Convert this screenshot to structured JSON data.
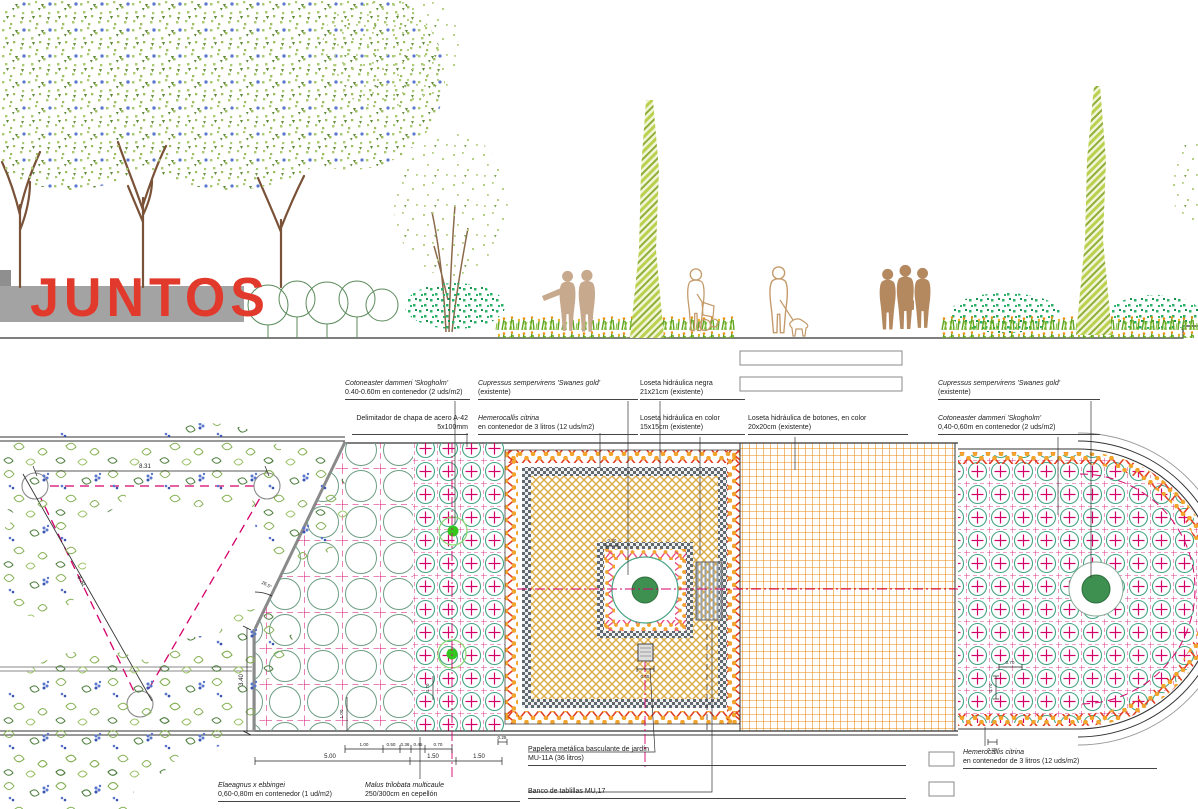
{
  "sign": {
    "text": "JUNTOS"
  },
  "plan": {
    "labels": {
      "cotoneaster_top": {
        "name": "Cotoneaster dammeri 'Skogholm'",
        "spec": "0.40-0.60m en contenedor (2 uds/m2)"
      },
      "cupressus_top": {
        "name": "Cupressus sempervirens 'Swanes gold'",
        "spec": "(existente)"
      },
      "loseta_negra": {
        "name": "Loseta hidráulica negra",
        "spec": "21x21cm (existente)"
      },
      "cupressus_right": {
        "name": "Cupressus sempervirens 'Swanes gold'",
        "spec": "(existente)"
      },
      "delimitador": {
        "name": "Delimitador de chapa de acero A-42",
        "spec": "5x100mm"
      },
      "hemerocallis_top": {
        "name": "Hemerocallis citrina",
        "spec": "en contenedor de 3 litros (12 uds/m2)"
      },
      "loseta_color": {
        "name": "Loseta hidráulica en color",
        "spec": "15x15cm (existente)"
      },
      "loseta_botones": {
        "name": "Loseta hidráulica de botones, en color",
        "spec": "20x20cm (existente)"
      },
      "cotoneaster_right": {
        "name": "Cotoneaster dammeri 'Skogholm'",
        "spec": "0,40-0,60m en contenedor (2 uds/m2)"
      },
      "elaeagnus": {
        "name": "Elaeagnus x ebbingei",
        "spec": "0,60-0,80m en contenedor (1 ud/m2)"
      },
      "malus": {
        "name": "Malus trilobata multicaule",
        "spec": "250/300cm en cepellón"
      },
      "papelera": {
        "name": "Papelera metálica basculante de jardín",
        "spec": "MU-11A (36 litros)"
      },
      "banco": {
        "name": "Banco de tablillas MU,17",
        "spec": ""
      },
      "hemerocallis_bottom": {
        "name": "Hemerocallis citrina",
        "spec": "en contenedor de 3 litros (12 uds/m2)"
      }
    },
    "dims": {
      "tri_width": "8.31",
      "tri_side": "8.31",
      "angle": "26.5°",
      "height": "3.40",
      "cell_a": "1.00",
      "r2_1": "1.00",
      "r2_2": "0.50",
      "r2_3": "0.36",
      "r2_4": "0.45",
      "r2_5": "0.70",
      "band_l": "0.25",
      "r1_1": "5.00",
      "r1_2": "1.50",
      "r1_3": "1.50",
      "inner": "0.30",
      "papelera": "0.45",
      "cap_h": "0.70",
      "cap_v": "0.70",
      "grid_b_v": "0.70",
      "band_r": "0.25"
    }
  },
  "colors": {
    "sign_red": "#e13a2c",
    "wall_gray": "#a3a3a3",
    "magenta": "#d4006a",
    "teal": "#3aa585",
    "orange": "#e8820c",
    "tan": "#dcaa44",
    "leaf_light": "#a9c46c",
    "leaf_dark": "#5f8a3c",
    "flower_blue": "#5b77cc",
    "trunk": "#7a5238",
    "people_tan": "#c7a98d",
    "people_brown": "#b5895f",
    "grass": "#61a31e",
    "zigzag_red": "#e23c20",
    "zigzag_pink": "#e84a86"
  }
}
